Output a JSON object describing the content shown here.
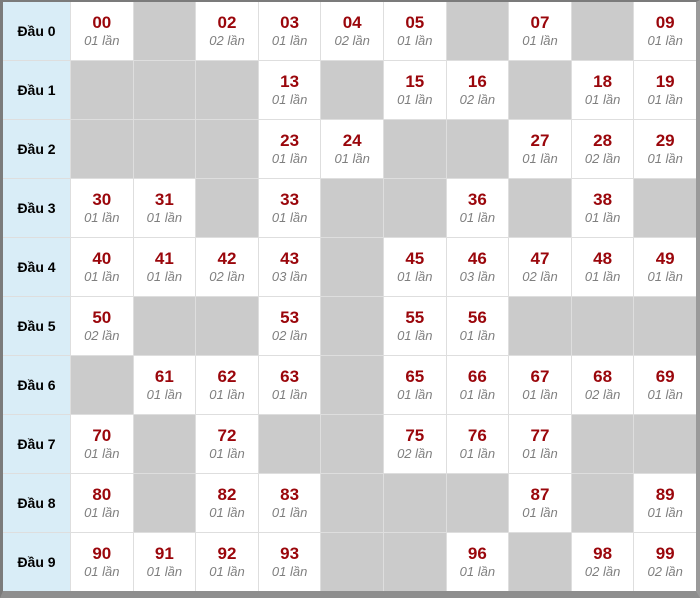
{
  "colors": {
    "number_text": "#9a060b",
    "count_text": "#7f7f7f",
    "row_header_bg": "#d9edf7",
    "filled_cell_bg": "#ffffff",
    "empty_cell_bg": "#cbcbcb",
    "grid_line": "#dedede",
    "frame_dark": "#7b7b7b",
    "frame_light": "#9a9a9a"
  },
  "chart_data": {
    "type": "table",
    "title": "",
    "row_header_prefix": "Đầu",
    "count_unit": "lần",
    "last_digit_columns": [
      0,
      1,
      2,
      3,
      4,
      5,
      6,
      7,
      8,
      9
    ],
    "rows": [
      {
        "label": "Đầu 0",
        "cells": [
          {
            "num": "00",
            "count": "01 lần"
          },
          null,
          {
            "num": "02",
            "count": "02 lần"
          },
          {
            "num": "03",
            "count": "01 lần"
          },
          {
            "num": "04",
            "count": "02 lần"
          },
          {
            "num": "05",
            "count": "01 lần"
          },
          null,
          {
            "num": "07",
            "count": "01 lần"
          },
          null,
          {
            "num": "09",
            "count": "01 lần"
          }
        ]
      },
      {
        "label": "Đầu 1",
        "cells": [
          null,
          null,
          null,
          {
            "num": "13",
            "count": "01 lần"
          },
          null,
          {
            "num": "15",
            "count": "01 lần"
          },
          {
            "num": "16",
            "count": "02 lần"
          },
          null,
          {
            "num": "18",
            "count": "01 lần"
          },
          {
            "num": "19",
            "count": "01 lần"
          }
        ]
      },
      {
        "label": "Đầu 2",
        "cells": [
          null,
          null,
          null,
          {
            "num": "23",
            "count": "01 lần"
          },
          {
            "num": "24",
            "count": "01 lần"
          },
          null,
          null,
          {
            "num": "27",
            "count": "01 lần"
          },
          {
            "num": "28",
            "count": "02 lần"
          },
          {
            "num": "29",
            "count": "01 lần"
          }
        ]
      },
      {
        "label": "Đầu 3",
        "cells": [
          {
            "num": "30",
            "count": "01 lần"
          },
          {
            "num": "31",
            "count": "01 lần"
          },
          null,
          {
            "num": "33",
            "count": "01 lần"
          },
          null,
          null,
          {
            "num": "36",
            "count": "01 lần"
          },
          null,
          {
            "num": "38",
            "count": "01 lần"
          },
          null
        ]
      },
      {
        "label": "Đầu 4",
        "cells": [
          {
            "num": "40",
            "count": "01 lần"
          },
          {
            "num": "41",
            "count": "01 lần"
          },
          {
            "num": "42",
            "count": "02 lần"
          },
          {
            "num": "43",
            "count": "03 lần"
          },
          null,
          {
            "num": "45",
            "count": "01 lần"
          },
          {
            "num": "46",
            "count": "03 lần"
          },
          {
            "num": "47",
            "count": "02 lần"
          },
          {
            "num": "48",
            "count": "01 lần"
          },
          {
            "num": "49",
            "count": "01 lần"
          }
        ]
      },
      {
        "label": "Đầu 5",
        "cells": [
          {
            "num": "50",
            "count": "02 lần"
          },
          null,
          null,
          {
            "num": "53",
            "count": "02 lần"
          },
          null,
          {
            "num": "55",
            "count": "01 lần"
          },
          {
            "num": "56",
            "count": "01 lần"
          },
          null,
          null,
          null
        ]
      },
      {
        "label": "Đầu 6",
        "cells": [
          null,
          {
            "num": "61",
            "count": "01 lần"
          },
          {
            "num": "62",
            "count": "01 lần"
          },
          {
            "num": "63",
            "count": "01 lần"
          },
          null,
          {
            "num": "65",
            "count": "01 lần"
          },
          {
            "num": "66",
            "count": "01 lần"
          },
          {
            "num": "67",
            "count": "01 lần"
          },
          {
            "num": "68",
            "count": "02 lần"
          },
          {
            "num": "69",
            "count": "01 lần"
          }
        ]
      },
      {
        "label": "Đầu 7",
        "cells": [
          {
            "num": "70",
            "count": "01 lần"
          },
          null,
          {
            "num": "72",
            "count": "01 lần"
          },
          null,
          null,
          {
            "num": "75",
            "count": "02 lần"
          },
          {
            "num": "76",
            "count": "01 lần"
          },
          {
            "num": "77",
            "count": "01 lần"
          },
          null,
          null
        ]
      },
      {
        "label": "Đầu 8",
        "cells": [
          {
            "num": "80",
            "count": "01 lần"
          },
          null,
          {
            "num": "82",
            "count": "01 lần"
          },
          {
            "num": "83",
            "count": "01 lần"
          },
          null,
          null,
          null,
          {
            "num": "87",
            "count": "01 lần"
          },
          null,
          {
            "num": "89",
            "count": "01 lần"
          }
        ]
      },
      {
        "label": "Đầu 9",
        "cells": [
          {
            "num": "90",
            "count": "01 lần"
          },
          {
            "num": "91",
            "count": "01 lần"
          },
          {
            "num": "92",
            "count": "01 lần"
          },
          {
            "num": "93",
            "count": "01 lần"
          },
          null,
          null,
          {
            "num": "96",
            "count": "01 lần"
          },
          null,
          {
            "num": "98",
            "count": "02 lần"
          },
          {
            "num": "99",
            "count": "02 lần"
          }
        ]
      }
    ]
  }
}
